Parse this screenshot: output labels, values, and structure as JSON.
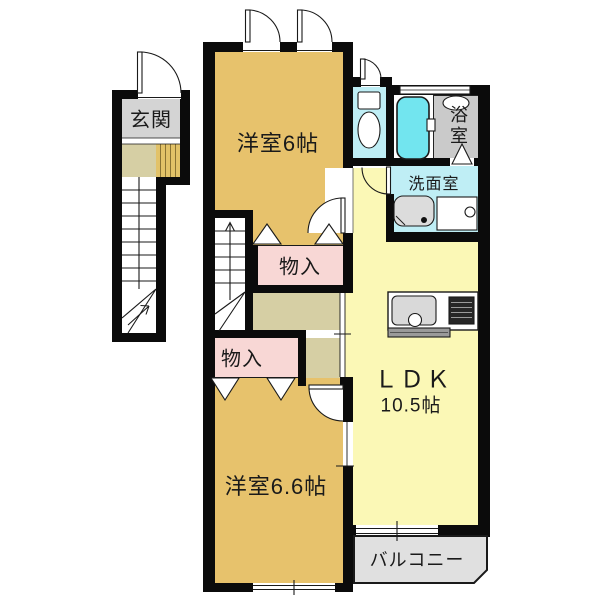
{
  "colors": {
    "wall": "#0b0b0b",
    "line": "#1a1a1a",
    "tan": "#e7c26c",
    "yellow": "#fbf8b6",
    "pink": "#f8d7d5",
    "olive": "#d6cfa4",
    "gray-tile": "#d4d4d4",
    "bath-gray": "#cacaca",
    "balcony-gray": "#e0e0e0",
    "cyan-light": "#bfeef5",
    "cyan-tub": "#72e5ef"
  },
  "rooms": {
    "genkan": {
      "label": "玄関"
    },
    "bedroom6": {
      "label": "洋室6帖"
    },
    "bath": {
      "label": "浴室"
    },
    "washroom": {
      "label": "洗面室"
    },
    "closet_upper": {
      "label": "物入"
    },
    "closet_lower": {
      "label": "物入"
    },
    "ldk": {
      "label": "ＬＤＫ",
      "size": "10.5帖"
    },
    "bedroom66": {
      "label": "洋室6.6帖"
    },
    "balcony": {
      "label": "バルコニー"
    }
  },
  "fixtures": [
    "toilet-icon",
    "bathtub-icon",
    "shower-icon",
    "bath-window-icon",
    "washbasin-icon",
    "washing-machine-pan-icon",
    "kitchen-sink-icon",
    "gas-stove-icon",
    "staircase-up-arrow-icon",
    "staircase-turn-arrow-icon",
    "door-swing-arc-icon",
    "folding-door-triangle-icon"
  ]
}
